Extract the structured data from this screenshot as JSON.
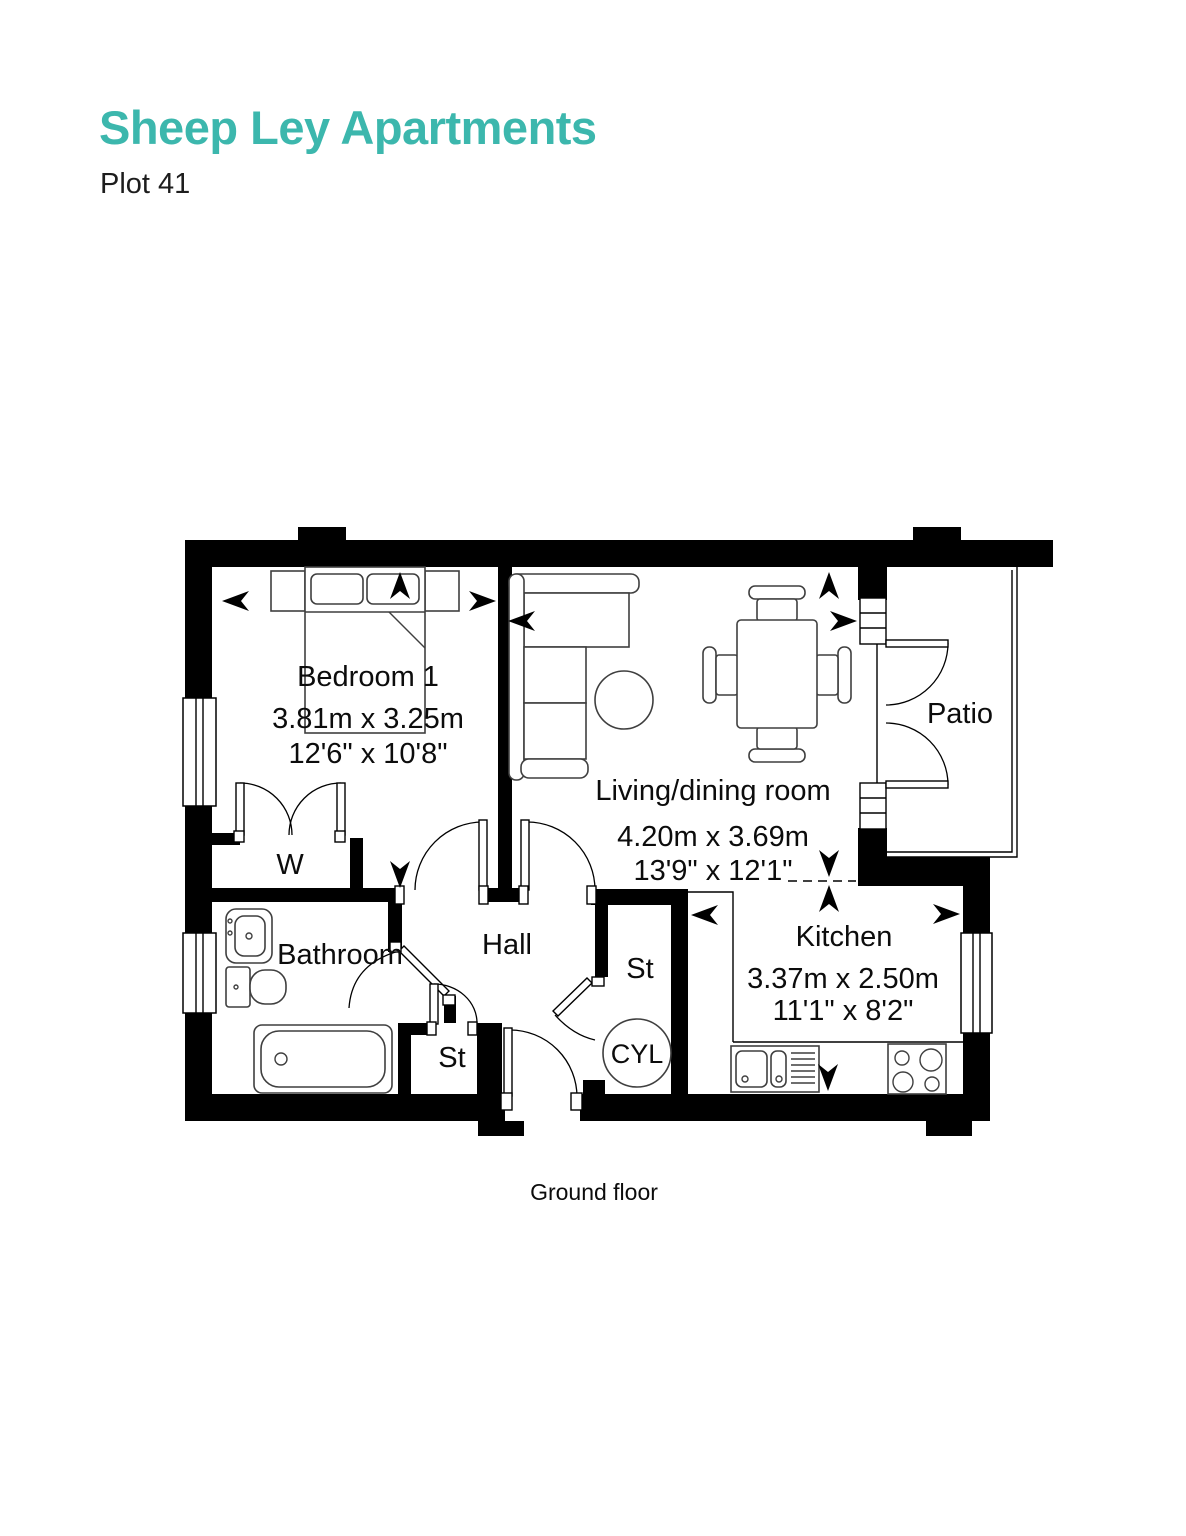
{
  "page": {
    "title": "Sheep Ley Apartments",
    "subtitle": "Plot 41",
    "caption": "Ground floor",
    "accent_color": "#3cb7ad",
    "ink_color": "#000000"
  },
  "rooms": {
    "bedroom": {
      "name": "Bedroom 1",
      "metric": "3.81m x 3.25m",
      "imperial": "12'6\" x 10'8\""
    },
    "living": {
      "name": "Living/dining room",
      "metric": "4.20m x 3.69m",
      "imperial": "13'9\" x 12'1\""
    },
    "kitchen": {
      "name": "Kitchen",
      "metric": "3.37m x 2.50m",
      "imperial": "11'1\" x 8'2\""
    },
    "bathroom": {
      "name": "Bathroom"
    },
    "hall": {
      "name": "Hall"
    },
    "patio": {
      "name": "Patio"
    },
    "wardrobe": {
      "abbr": "W"
    },
    "store_left": {
      "abbr": "St"
    },
    "store_right": {
      "abbr": "St"
    },
    "cylinder": {
      "abbr": "CYL"
    }
  }
}
